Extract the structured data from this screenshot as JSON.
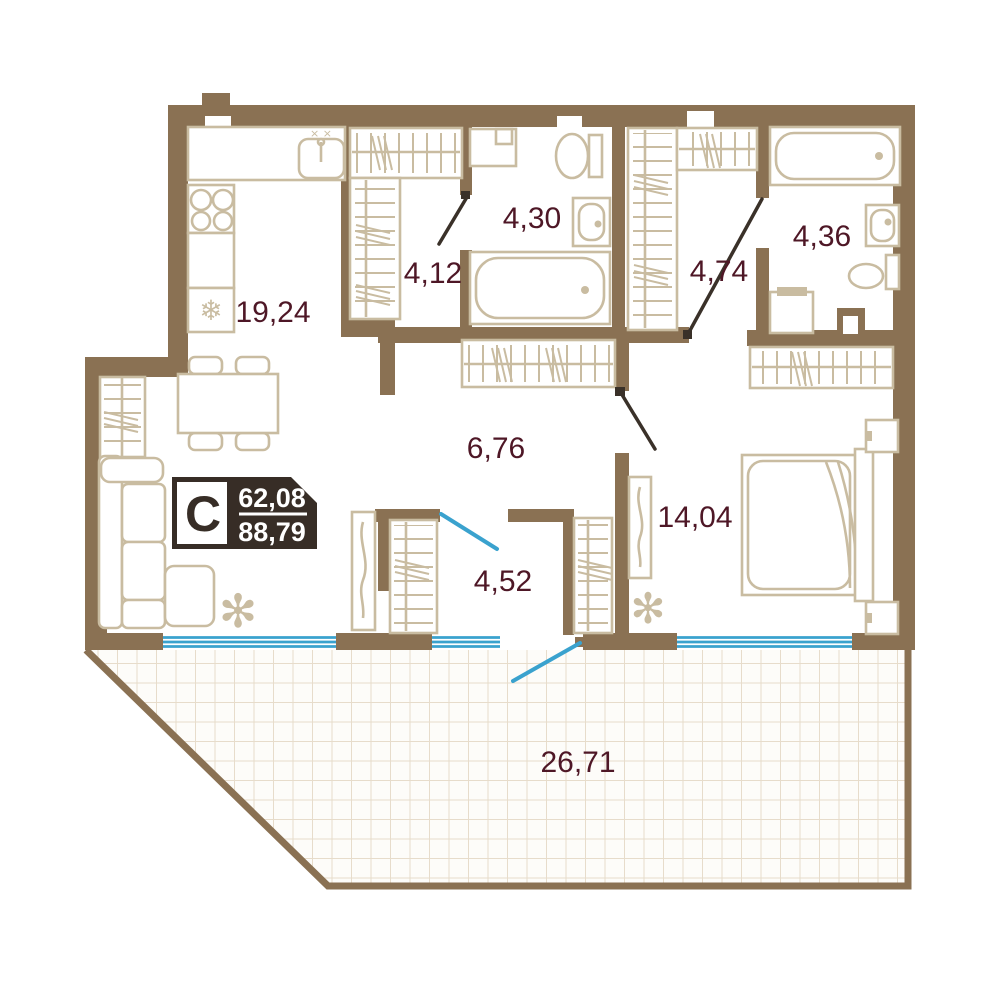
{
  "plan": {
    "type": "apartment-floor-plan",
    "badge": {
      "section_letter": "C",
      "area_top": "62,08",
      "area_bottom": "88,79"
    },
    "rooms": {
      "kitchen_living": {
        "area": "19,24"
      },
      "wardrobe_left": {
        "area": "4,12"
      },
      "bathroom_left": {
        "area": "4,30"
      },
      "wardrobe_right": {
        "area": "4,74"
      },
      "bathroom_right": {
        "area": "4,36"
      },
      "hallway": {
        "area": "6,76"
      },
      "dressing_room": {
        "area": "4,52"
      },
      "bedroom": {
        "area": "14,04"
      },
      "terrace": {
        "area": "26,71"
      }
    },
    "icons": {
      "fridge_snowflake": "❄",
      "plant_flower": "✻",
      "sink_marks": "× ×"
    },
    "colors": {
      "wall": "#8a7153",
      "furniture_line": "#c9bca1",
      "room_label": "#4e1726",
      "window_blue": "#3aa2ce",
      "door_dark": "#3a3129",
      "badge_background": "#372d26",
      "terrace_grid": "#e7dccb"
    }
  }
}
